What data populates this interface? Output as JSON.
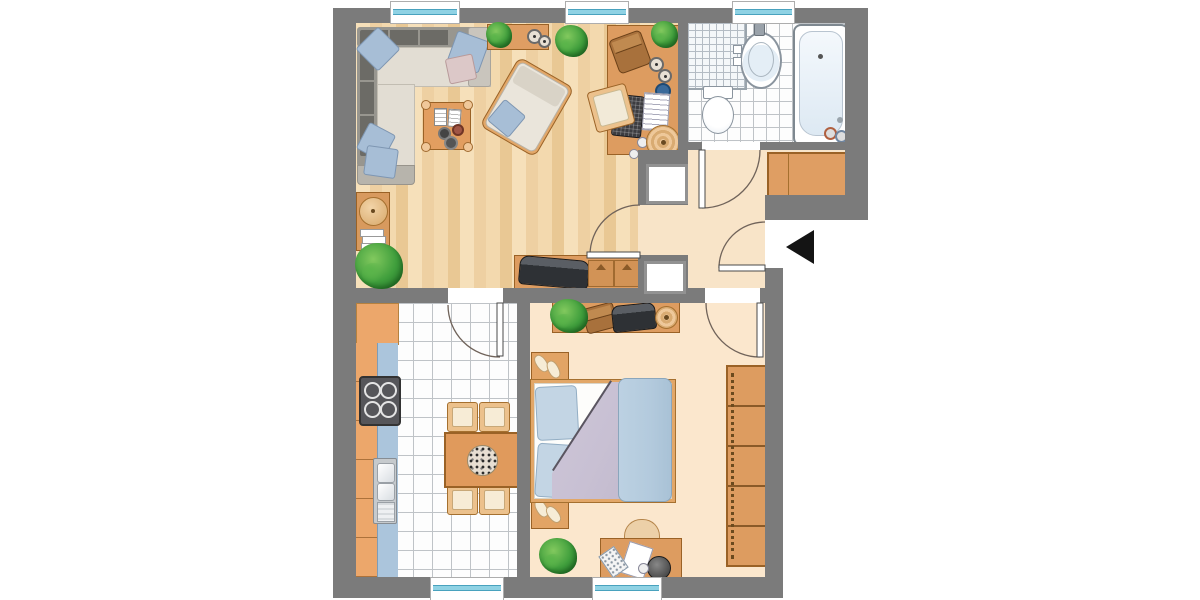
{
  "plan": {
    "kind": "apartment-floor-plan",
    "entrance_side": "right",
    "entrance_marker": "black-arrow-icon"
  },
  "rooms": [
    {
      "id": "living-room",
      "floor": "wood-parquet",
      "furniture": [
        "corner-sofa",
        "sofa-pillows",
        "coffee-table",
        "books",
        "cups",
        "armchair",
        "sideboard",
        "round-containers",
        "large-plant",
        "work-desk",
        "desk-bag",
        "laptop",
        "notepad",
        "desk-chair",
        "tv-lowboard",
        "tv",
        "drawers",
        "wall-shelf",
        "round-lamp",
        "magazines",
        "floor-plant"
      ]
    },
    {
      "id": "bathroom",
      "floor": "white-tile",
      "furniture": [
        "shower-tile-area",
        "washbasin",
        "faucet",
        "toiletry-items",
        "toilet",
        "cistern",
        "bathtub",
        "drain",
        "hot-tap",
        "cold-tap"
      ]
    },
    {
      "id": "hallway",
      "floor": "screed",
      "furniture": [
        "built-in-wardrobe",
        "wall-niche-upper",
        "wall-niche-lower",
        "entrance-door"
      ]
    },
    {
      "id": "kitchen",
      "floor": "white-tile",
      "furniture": [
        "tall-cabinet",
        "base-cabinets",
        "countertop",
        "stove",
        "double-sink",
        "dining-table",
        "flower-centerpiece",
        "chair",
        "chair",
        "chair",
        "chair"
      ]
    },
    {
      "id": "bedroom",
      "floor": "screed",
      "furniture": [
        "sideboard",
        "plant",
        "bag",
        "tv",
        "dish",
        "nightstand",
        "slippers",
        "nightstand",
        "slippers",
        "double-bed",
        "pillows",
        "duvet",
        "blanket",
        "wardrobe",
        "desk",
        "desk-chair",
        "paper",
        "calculator",
        "desk-lamp",
        "floor-plant"
      ]
    }
  ],
  "counts": {
    "windows_total": 5,
    "windows_top": 3,
    "windows_bottom": 2,
    "interior_doors": 4,
    "entrance_doors": 1,
    "wardrobe_sections": 5,
    "stove_burners": 4,
    "dining_chairs": 4,
    "wall_niches": 2
  },
  "palette": {
    "wall": "#7b7b7b",
    "woodA": "#f6e0ba",
    "woodB": "#eed0a2",
    "woodC": "#f3d9ae",
    "woodD": "#e9c894",
    "hallFloor": "#f8e4c8",
    "bedFloor": "#fbe7cd",
    "tileLine": "#bfc3c7",
    "glass": "#8fd2e4",
    "furn": "#df9e63",
    "furnEdge": "#9a6226",
    "furnLight": "#ecc18c",
    "counter": "#abc5dc",
    "sofaSeat": "#e2ddd3",
    "sofaBack": "#6c6b66",
    "sofaFrame": "#98968f",
    "pillowBlue": "#a7bed6",
    "pillowPink": "#dcc8c8",
    "bedPillow": "#c3d5e4",
    "duvet": "#c8c0d3",
    "blanket": "#b3cadd",
    "plantLight": "#82c95e",
    "plantMid": "#3f9e3c",
    "plantDark": "#1f6e28",
    "applianceDark": "#56565a",
    "tvDark": "#2e3135",
    "fixtureRim": "#8a949e",
    "fixtureFill": "#e4eef6",
    "arrow": "#141414"
  }
}
